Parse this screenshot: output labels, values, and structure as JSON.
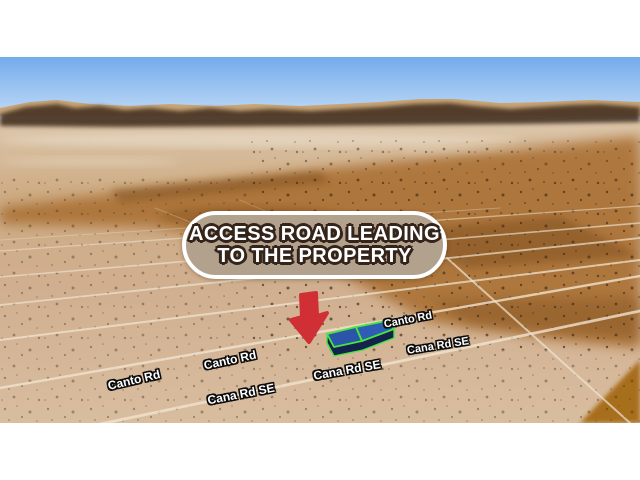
{
  "map": {
    "view_type": "aerial-3d-satellite-view",
    "callout": {
      "line1": "ACCESS ROAD LEADING",
      "line2": "TO THE PROPERTY"
    },
    "road_labels": [
      {
        "text": "Canto Rd"
      },
      {
        "text": "Cana Rd SE"
      },
      {
        "text": "Cana Rd SE"
      },
      {
        "text": "Canto Rd"
      },
      {
        "text": "Cana Rd SE"
      },
      {
        "text": "Canto Rd"
      }
    ],
    "property": {
      "parcels_outlined": 2
    },
    "colors": {
      "callout_bg": "#b2a18d",
      "callout_border": "#ffffff",
      "callout_text": "#ffffff",
      "callout_text_outline": "#34241a",
      "arrow_red": "#d02f35",
      "parcel_fill_blue": "#2b55a8",
      "parcel_side_navy": "#16224e",
      "parcel_outline_green": "#45e73c",
      "sky_top": "#74abec",
      "sky_horizon": "#d3e4f8",
      "desert_tan": "#d0ae8e",
      "desert_orange": "#aa7134",
      "road_line": "#f0e4d0"
    }
  }
}
